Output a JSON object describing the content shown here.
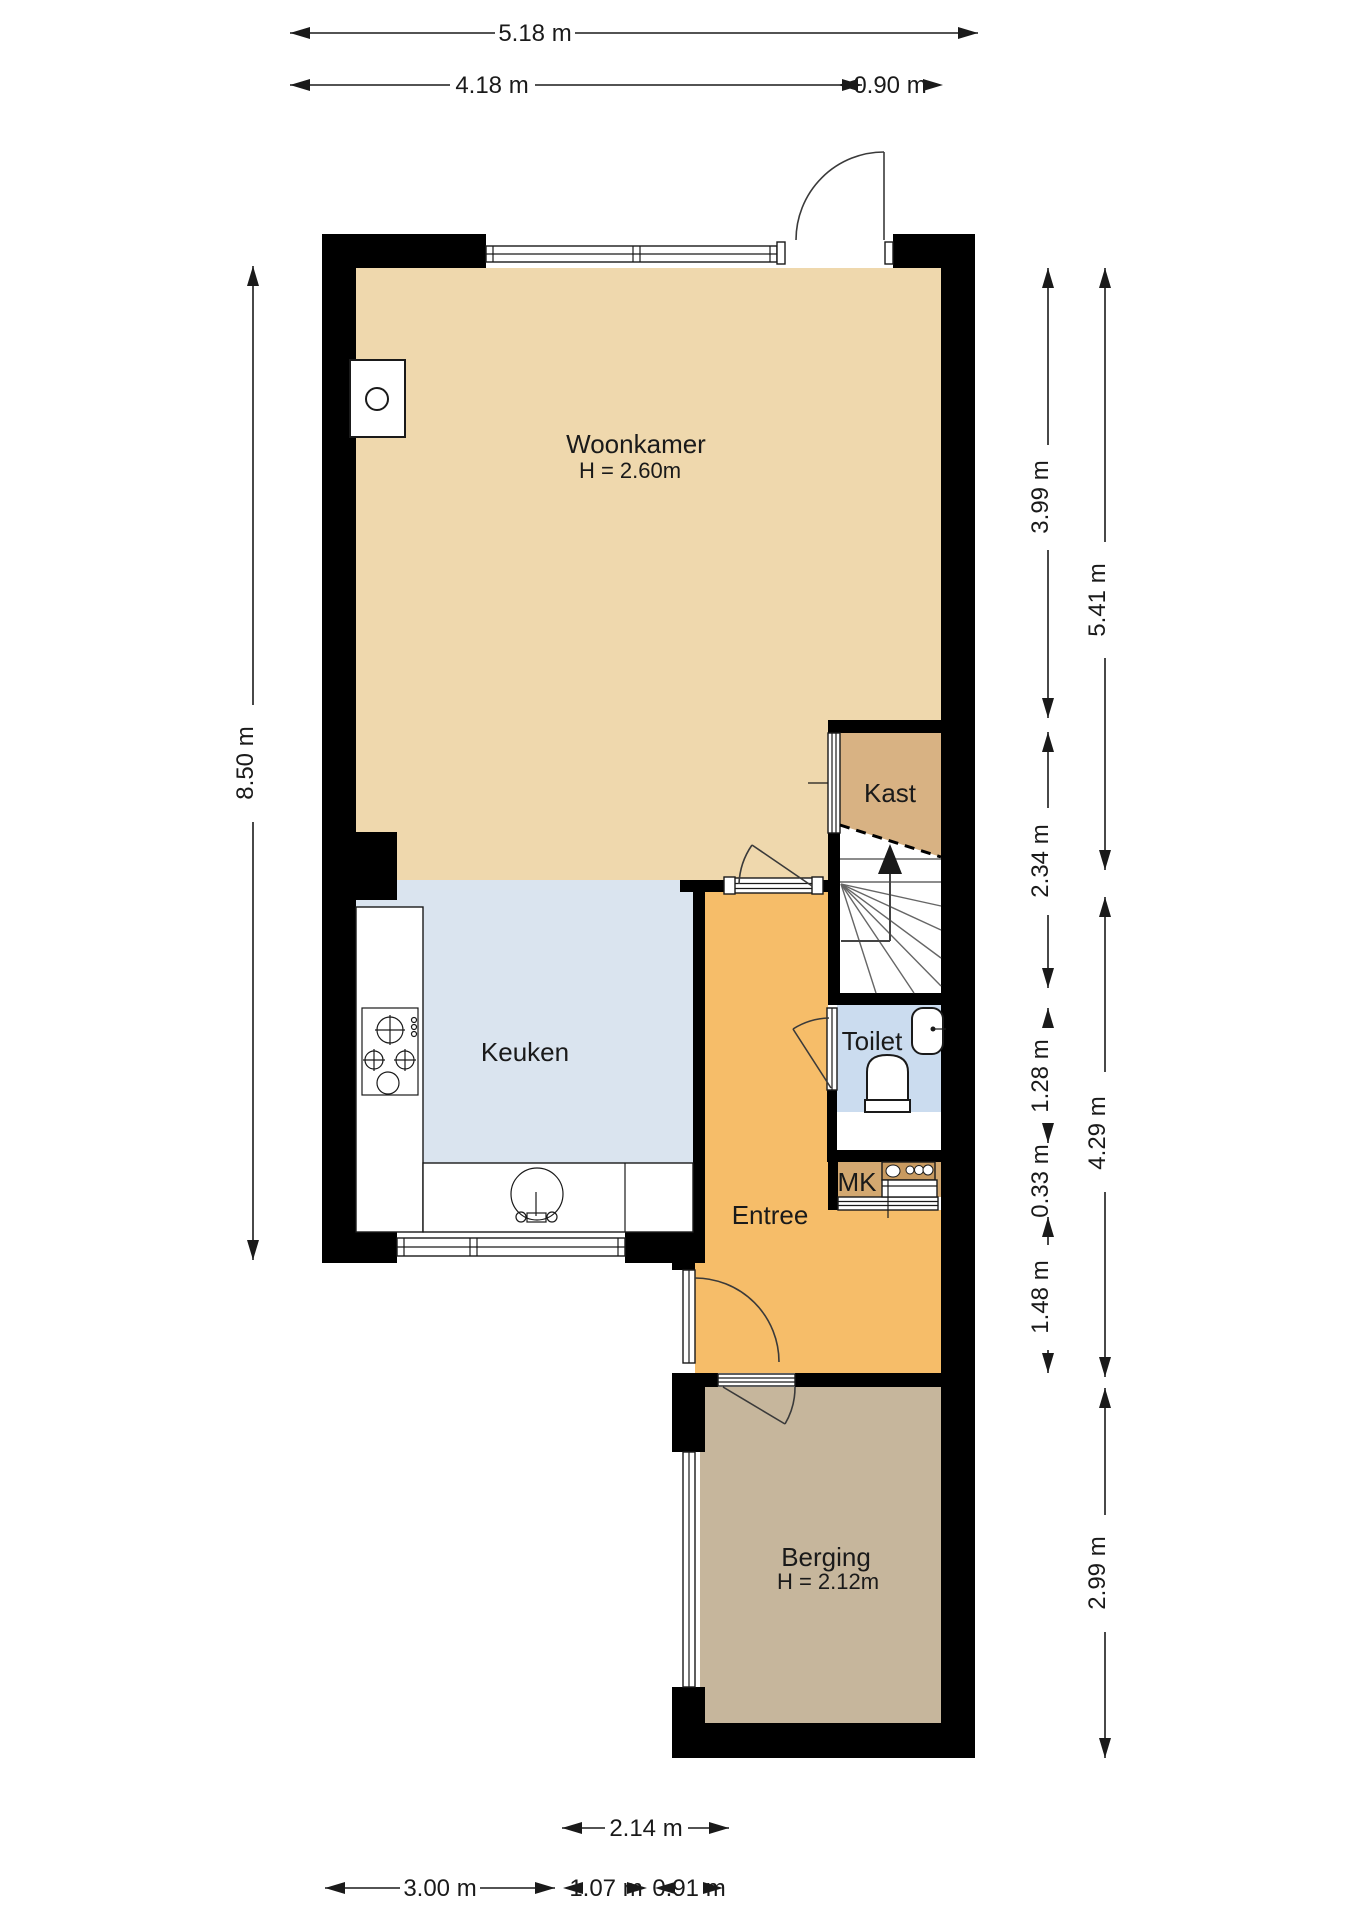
{
  "plan_title": "Begane grond plattegrond",
  "colors": {
    "woonkamer": "#efd8ad",
    "kast": "#d8b283",
    "keuken": "#dae4ef",
    "toilet": "#cbdcef",
    "entree": "#f6bd69",
    "mk": "#d3a870",
    "berging": "#c6b69c",
    "wall": "#000000",
    "background": "#ffffff"
  },
  "rooms": {
    "woonkamer": {
      "label": "Woonkamer",
      "height_label": "H = 2.60m"
    },
    "kast": {
      "label": "Kast"
    },
    "keuken": {
      "label": "Keuken"
    },
    "toilet": {
      "label": "Toilet"
    },
    "mk": {
      "label": "MK"
    },
    "entree": {
      "label": "Entree"
    },
    "berging": {
      "label": "Berging",
      "height_label": "H = 2.12m"
    }
  },
  "dimensions": {
    "top": {
      "total": "5.18 m",
      "left_part": "4.18 m",
      "right_part": "0.90 m"
    },
    "left": {
      "total": "8.50 m"
    },
    "right_inner": {
      "woonkamer": "3.99 m",
      "kast_stairs": "2.34 m",
      "toilet": "1.28 m",
      "mk": "0.33 m",
      "entree": "1.48 m"
    },
    "right_outer": {
      "upper": "5.41 m",
      "middle": "4.29 m",
      "berging": "2.99 m"
    },
    "bottom": {
      "berging_width": "2.14 m",
      "keuken_width": "3.00 m",
      "entree_width": "1.07 m",
      "door_width": "0.91 m"
    }
  },
  "icons": {
    "stairs_up_arrow": "stairs-direction-up",
    "stove": "stove-unit",
    "hob": "gas-hob-4-burners",
    "sink": "round-kitchen-sink",
    "wc": "toilet-bowl",
    "basin": "hand-wash-basin",
    "boiler": "boiler-unit"
  }
}
